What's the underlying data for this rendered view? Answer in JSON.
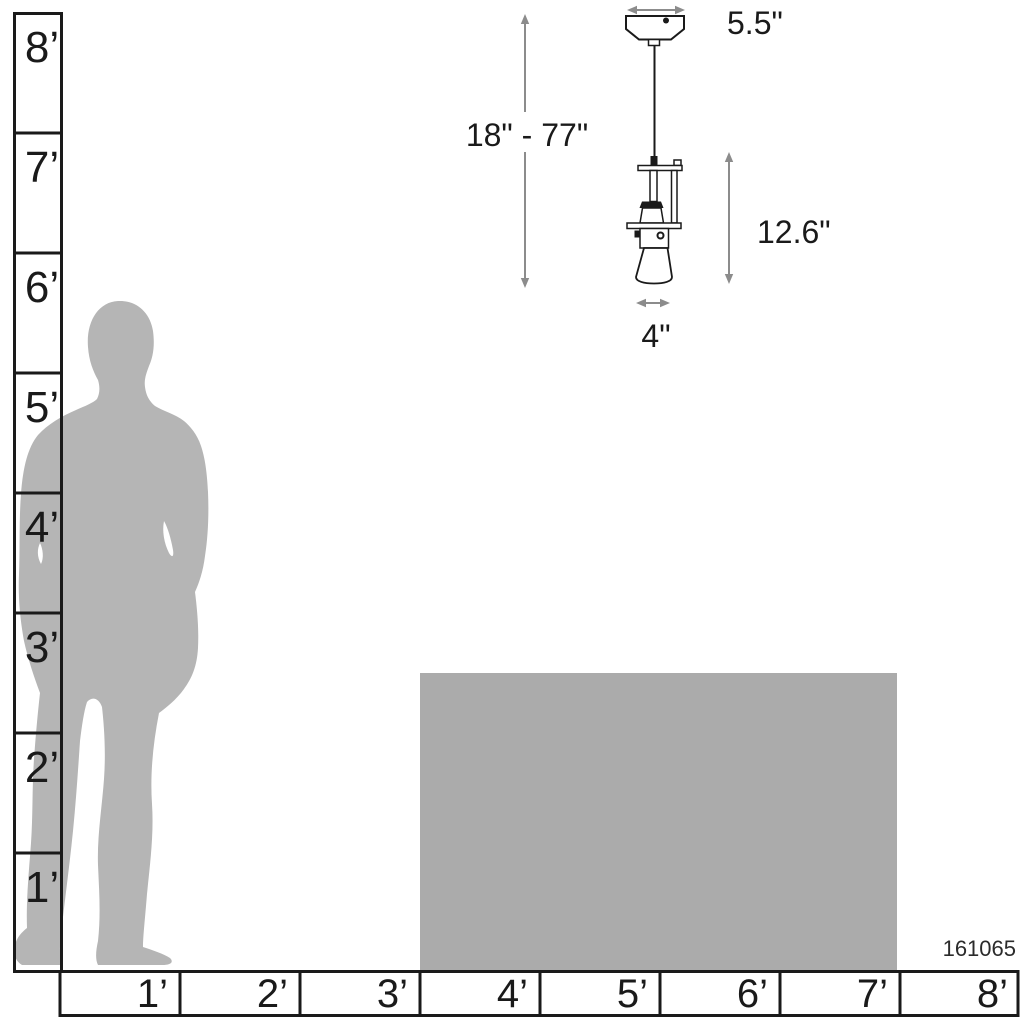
{
  "product": {
    "sku": "161065"
  },
  "dimensions": {
    "canopy_width": "5.5\"",
    "hanging_height_range": "18\" - 77\"",
    "fixture_height": "12.6\"",
    "fixture_width": "4\""
  },
  "rulers": {
    "vertical": {
      "unit": "feet",
      "labels": [
        "8’",
        "7’",
        "6’",
        "5’",
        "4’",
        "3’",
        "2’",
        "1’"
      ]
    },
    "horizontal": {
      "unit": "feet",
      "labels": [
        "1’",
        "2’",
        "3’",
        "4’",
        "5’",
        "6’",
        "7’",
        "8’"
      ]
    }
  },
  "figure": {
    "person": "human-silhouette-for-scale",
    "counter": "counter-height-block-for-scale",
    "fixture": "mini-pendant-light-line-drawing"
  },
  "colors": {
    "silhouette_gray": "#b5b5b5",
    "counter_gray": "#ababab",
    "line_black": "#1a1a1a",
    "arrow_gray": "#8c8c8c",
    "background": "#ffffff"
  }
}
